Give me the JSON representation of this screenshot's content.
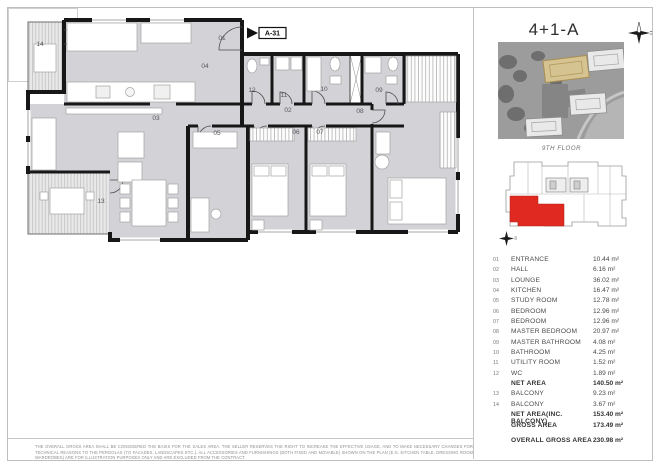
{
  "sheet": {
    "title": "4+1-A",
    "floor_label": "9TH FLOOR",
    "unit_marker": "A-31"
  },
  "plan": {
    "room_labels": [
      {
        "num": "01",
        "x": 222,
        "y": 160
      },
      {
        "num": "02",
        "x": 288,
        "y": 232
      },
      {
        "num": "03",
        "x": 156,
        "y": 240
      },
      {
        "num": "04",
        "x": 205,
        "y": 188
      },
      {
        "num": "05",
        "x": 217,
        "y": 255
      },
      {
        "num": "06",
        "x": 296,
        "y": 254
      },
      {
        "num": "07",
        "x": 320,
        "y": 254
      },
      {
        "num": "08",
        "x": 360,
        "y": 233
      },
      {
        "num": "09",
        "x": 379,
        "y": 212
      },
      {
        "num": "10",
        "x": 324,
        "y": 211
      },
      {
        "num": "11",
        "x": 284,
        "y": 217
      },
      {
        "num": "12",
        "x": 252,
        "y": 212
      },
      {
        "num": "13",
        "x": 101,
        "y": 323
      },
      {
        "num": "14",
        "x": 40,
        "y": 166
      }
    ]
  },
  "area_table": {
    "rows": [
      {
        "no": "01",
        "name": "ENTRANCE",
        "value": "10.44 m²",
        "bold": false,
        "spaced": false
      },
      {
        "no": "02",
        "name": "HALL",
        "value": "6.16 m²",
        "bold": false,
        "spaced": false
      },
      {
        "no": "03",
        "name": "LOUNGE",
        "value": "36.02 m²",
        "bold": false,
        "spaced": false
      },
      {
        "no": "04",
        "name": "KITCHEN",
        "value": "16.47 m²",
        "bold": false,
        "spaced": false
      },
      {
        "no": "05",
        "name": "STUDY ROOM",
        "value": "12.78 m²",
        "bold": false,
        "spaced": false
      },
      {
        "no": "06",
        "name": "BEDROOM",
        "value": "12.96 m²",
        "bold": false,
        "spaced": false
      },
      {
        "no": "07",
        "name": "BEDROOM",
        "value": "12.96 m²",
        "bold": false,
        "spaced": false
      },
      {
        "no": "08",
        "name": "MASTER BEDROOM",
        "value": "20.97 m²",
        "bold": false,
        "spaced": false
      },
      {
        "no": "09",
        "name": "MASTER BATHROOM",
        "value": "4.08 m²",
        "bold": false,
        "spaced": false
      },
      {
        "no": "10",
        "name": "BATHROOM",
        "value": "4.25 m²",
        "bold": false,
        "spaced": false
      },
      {
        "no": "11",
        "name": "UTILITY ROOM",
        "value": "1.52 m²",
        "bold": false,
        "spaced": false
      },
      {
        "no": "12",
        "name": "WC",
        "value": "1.89 m²",
        "bold": false,
        "spaced": false
      },
      {
        "no": "",
        "name": "NET AREA",
        "value": "140.50 m²",
        "bold": true,
        "spaced": false
      },
      {
        "no": "13",
        "name": "BALCONY",
        "value": "9.23 m²",
        "bold": false,
        "spaced": false
      },
      {
        "no": "14",
        "name": "BALCONY",
        "value": "3.67 m²",
        "bold": false,
        "spaced": false
      },
      {
        "no": "",
        "name": "NET AREA(INC. BALCONY)",
        "value": "153.40 m²",
        "bold": true,
        "spaced": false
      },
      {
        "no": "",
        "name": "GROSS AREA",
        "value": "173.49 m²",
        "bold": true,
        "spaced": false
      },
      {
        "no": "",
        "name": "OVERALL GROSS AREA",
        "value": "230.98 m²",
        "bold": true,
        "spaced": true
      }
    ]
  },
  "disclaimer": {
    "line1": "THE OVERALL GROSS AREA SHALL BE CONSIDERED THE BASIS FOR THE SALES AREA. THE SELLER RESERVES THE RIGHT TO INCREASE THE EFFECTIVE USAGE, AND TO MAKE NECESSARY CHANGES FOR TECHNICAL REASONS TO THE PERGOLAS (TO FACADES, LANDSCAPES ETC.). ALL",
    "line2": "ACCESSORIES AND FURNISHINGS (BOTH FIXED AND MOVABLE) SHOWN ON THE PLAN (E.G. KITCHEN TABLE, DRESSING ROOM WARDROBES) ARE FOR ILLUSTRATION PURPOSES ONLY AND ARE EXCLUDED FROM THE CONTRACT."
  },
  "colors": {
    "wall": "#171717",
    "room_fill": "#d3d3d7",
    "balcony_fill": "#e8e8e8",
    "unit_red": "#e02a21",
    "satellite_highlight": "#d6c392"
  }
}
